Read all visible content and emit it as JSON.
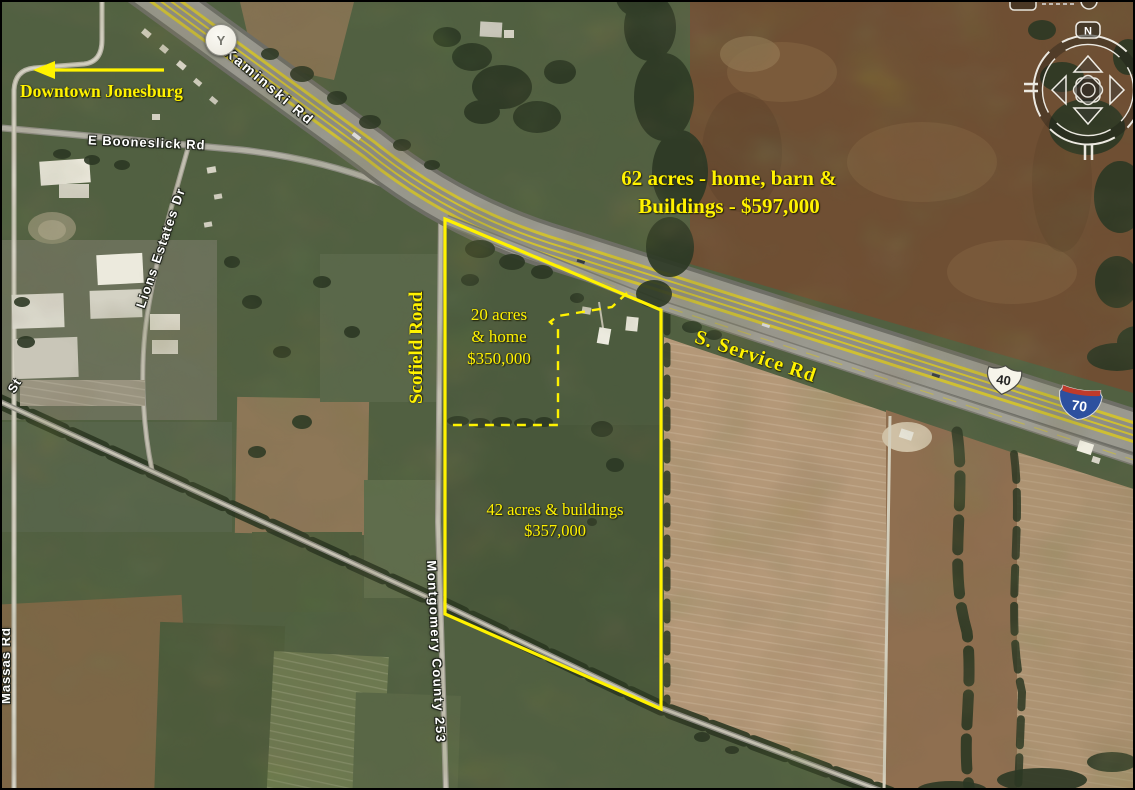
{
  "annotations": {
    "downtown_label": "Downtown Jonesburg",
    "listing_62": {
      "line1": "62 acres - home, barn  &",
      "line2": "Buildings - $597,000"
    },
    "listing_20": {
      "line1": "20 acres",
      "line2": "& home",
      "line3": "$350,000"
    },
    "listing_42": {
      "line1": "42 acres & buildings",
      "line2": "$357,000"
    }
  },
  "roads": {
    "kaminski": "Kaminski Rd",
    "booneslick": "E Booneslick Rd",
    "lions_estates": "Lions Estates Dr",
    "scofield": "Scofield Road",
    "service": "S. Service Rd",
    "montgomery": "Montgomery County 253",
    "massas": "Massas Rd",
    "st": "St"
  },
  "markers": {
    "route_y": "Y",
    "us40": "40",
    "i70": "70"
  },
  "compass": {
    "north": "N"
  },
  "colors": {
    "annotation_yellow": "#fff200",
    "road_label_white": "#ffffff",
    "us_shield_fill": "#f6f4ea",
    "i70_blue": "#2d509f",
    "i70_red": "#bf3a2b"
  }
}
